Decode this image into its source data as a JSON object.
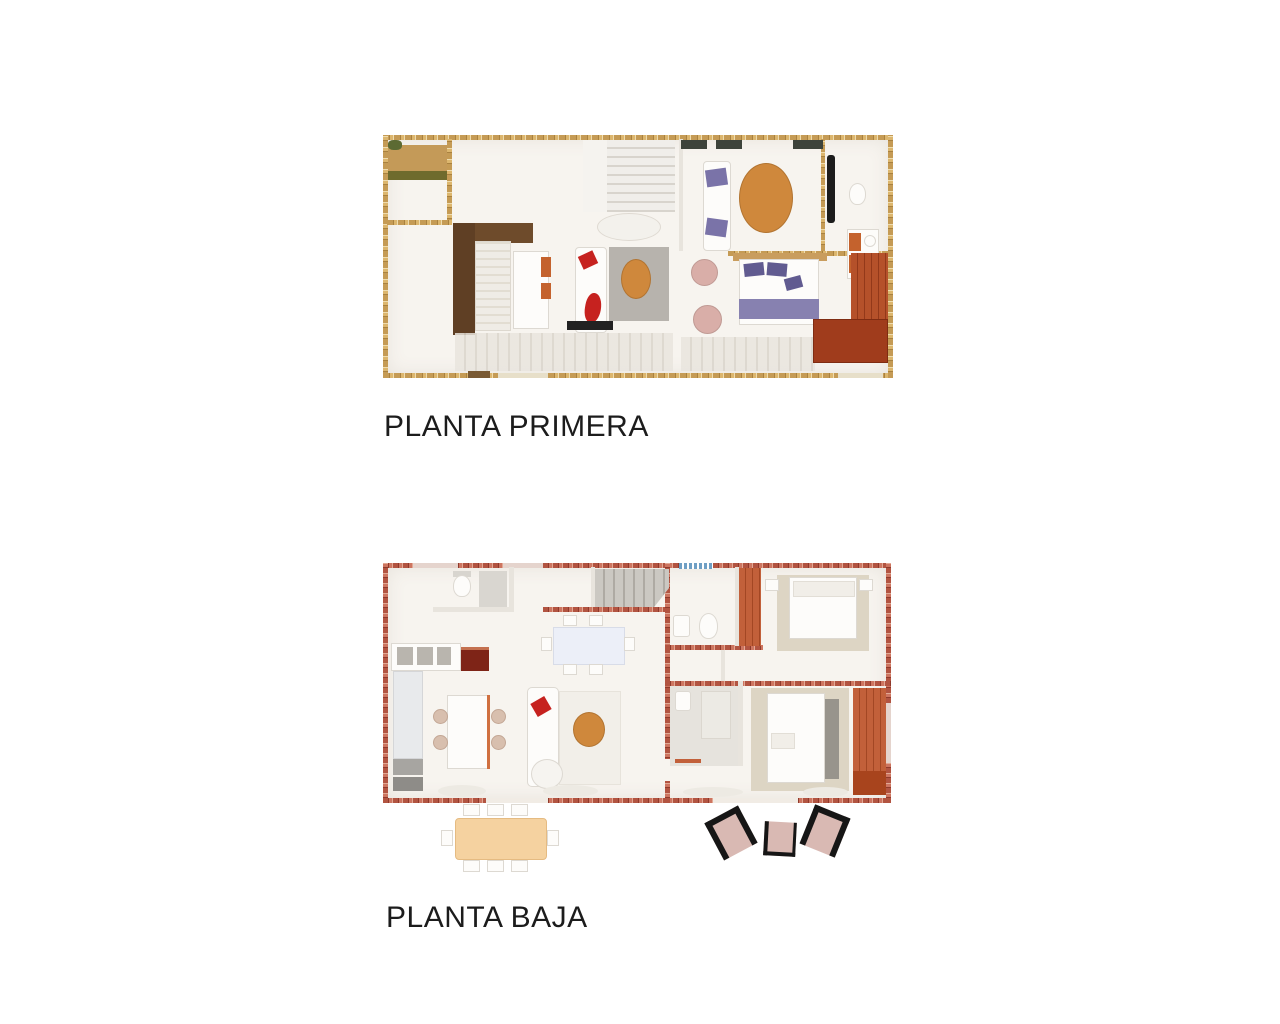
{
  "figures": [
    {
      "id": "planta-primera",
      "label": "PLANTA PRIMERA"
    },
    {
      "id": "planta-baja",
      "label": "PLANTA BAJA"
    }
  ],
  "theme": {
    "page-bg": "#ffffff",
    "caption": "#1c1c1c",
    "floor": "#f7f4ef",
    "wall-gold": "#c59b55",
    "wall-gold-dark": "#a9813f",
    "wall-gold-light": "#dcb66e",
    "wall-red": "#b25441",
    "wall-red-dark": "#8f3a2c",
    "wall-red-light": "#cd7560",
    "wood-dark": "#6e4b2b",
    "wood-darker": "#5f3f24",
    "wardrobe-red": "#b5512a",
    "wardrobe-red-dark": "#93391a",
    "wardrobe-orange": "#c2603a",
    "table-orange": "#cf883c",
    "bed-purple": "#8781b0",
    "pillow-purple": "#615b90",
    "cushion-red": "#c6221f",
    "pouf-pink": "#d9aea8",
    "rug-gray": "#b7b3ad",
    "rug-beige": "#ddd5c4",
    "island-blue": "#e8eaec",
    "dining-white": "#eceff8",
    "terrace-tan": "#c49a58",
    "terrace-olive": "#6f6b2d",
    "window-blue": "#6f9fc4",
    "outdoor-table": "#f5d2a0",
    "outdoor-cushion": "#d9b9b3",
    "frame-black": "#161616"
  }
}
